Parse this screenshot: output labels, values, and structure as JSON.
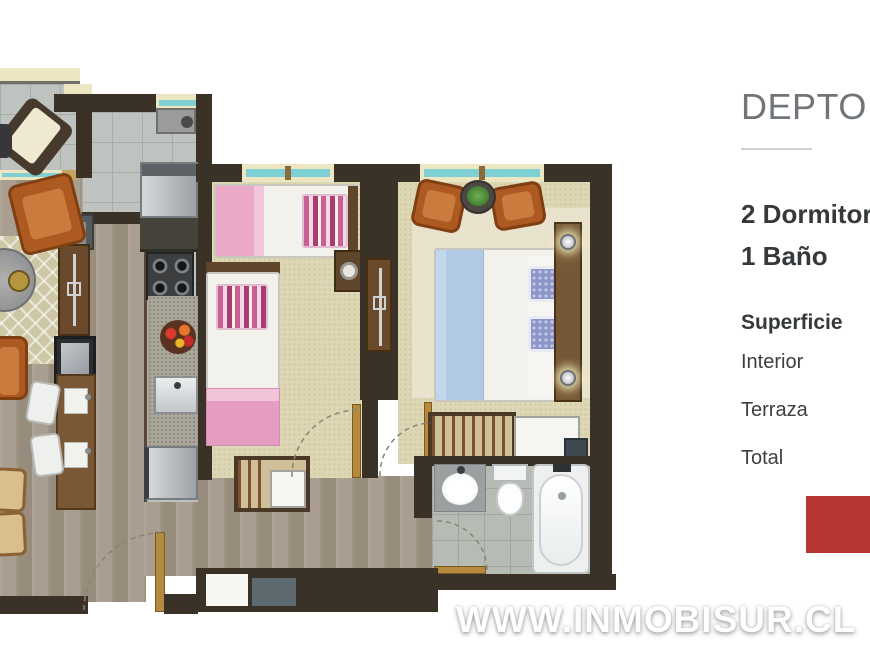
{
  "panel": {
    "title": "DEPTO 54",
    "bedrooms": "2 Dormitorios",
    "bathrooms": "1 Baño",
    "surface_heading": "Superficie",
    "surface_rows": [
      "Interior",
      "Terraza",
      "Total"
    ],
    "accent_color": "#b53734"
  },
  "watermark": {
    "text": "WWW.INMOBISUR.CL"
  },
  "floorplan": {
    "colors": {
      "wall": "#3b3227",
      "wood_floor": "#a59a8c",
      "tile_floor": "#bfc3bf",
      "carpet": "#ded7b5",
      "window_glass": "#7fd0d4",
      "accent_red": "#b53734"
    }
  }
}
